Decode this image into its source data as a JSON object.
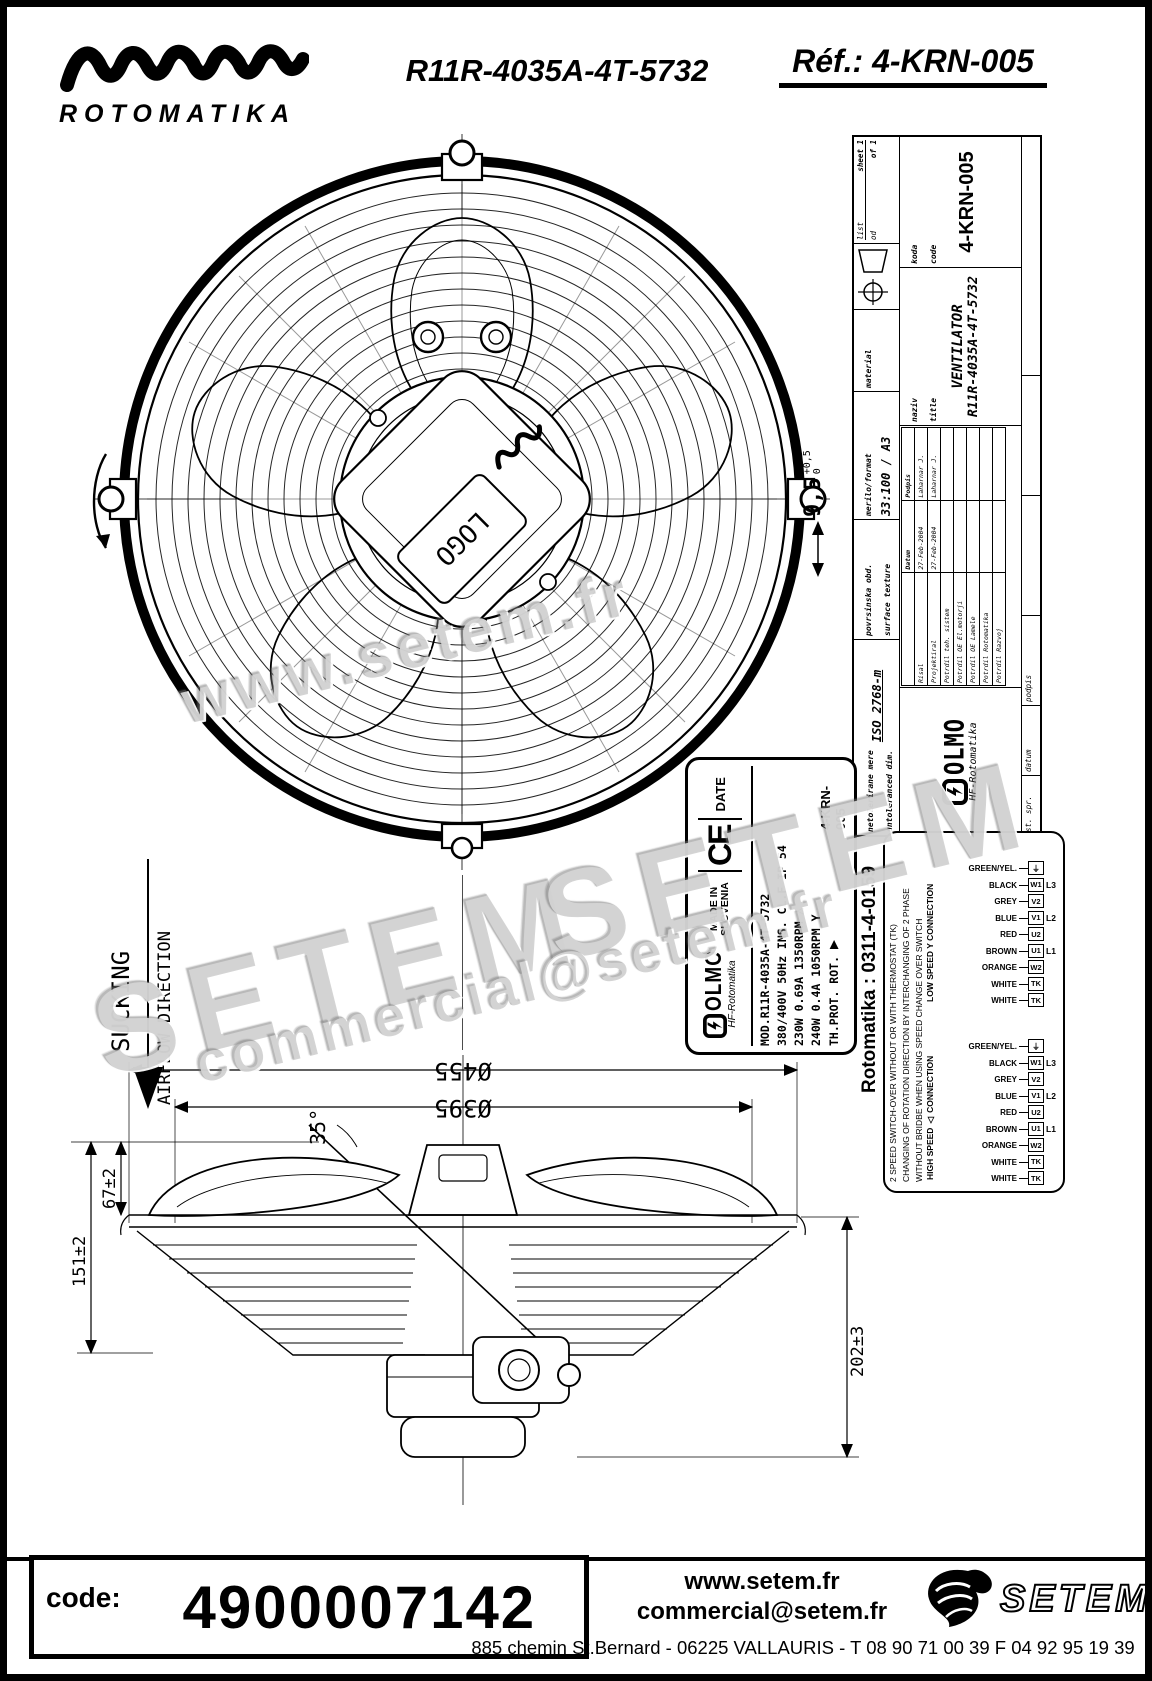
{
  "header": {
    "brand": "ROTOMATIKA",
    "model": "R11R-4035A-4T-5732",
    "ref": "Réf.: 4-KRN-005"
  },
  "front_view": {
    "hub_text": "LOGO",
    "thickness": {
      "value": "9,5",
      "tol_up": "+0,5",
      "tol_dn": "0"
    }
  },
  "airflow": {
    "word": "SUCKING",
    "label": "AIRFLOW DIRECTION"
  },
  "title_block": {
    "untol_sl": "netolerirane mere",
    "untol_en": "untoleranced dim.",
    "iso": "ISO 2768-m",
    "surf_sl": "povrsinska obd.",
    "surf_en": "surface texture",
    "scale_label": "merilo/format",
    "scale": "33:100 / A3",
    "material_label": "material",
    "title_label_sl": "naziv",
    "title_label_en": "title",
    "title1": "VENTILATOR",
    "title2": "R11R-4035A-4T-5732",
    "code_label_sl": "koda",
    "code_label_en": "code",
    "code": "4-KRN-005",
    "sheet_label_sl": "list",
    "sheet_label_en": "sheet 1",
    "of_sl": "od",
    "of_en": "of 1",
    "col_datum": "Datum",
    "col_podpis": "Podpis",
    "rows": [
      {
        "role": "Risal",
        "date": "27-Feb-2004",
        "name": "Laharnar J."
      },
      {
        "role": "Projektiral",
        "date": "27-Feb-2004",
        "name": "Laharnar J."
      },
      {
        "role": "Potrdil teh. sistem",
        "date": "",
        "name": ""
      },
      {
        "role": "Potrdil OE El.motorji",
        "date": "",
        "name": ""
      },
      {
        "role": "Potrdil OE Lamele",
        "date": "",
        "name": ""
      },
      {
        "role": "Potrdil Rotomatika",
        "date": "",
        "name": ""
      },
      {
        "role": "Potrdil Razvoj",
        "date": "",
        "name": ""
      }
    ],
    "footer_cols": [
      "st. spr.",
      "datum",
      "podpis"
    ],
    "brand": "OLMO",
    "brand_sub": "HF-Rotomatika"
  },
  "label": {
    "brand": "OLMO",
    "brand_sub": "HF-Rotomatika",
    "made_in": "MADE IN",
    "country": "SLOVENIA",
    "ce": "CE",
    "date": "DATE",
    "l1": "MOD.R11R-4035A-4T-5732",
    "l2": "380/400V 50Hz INS. CL.F IP 54",
    "l3": "230W 0.69A 1350RPM △",
    "l4": "240W 0.4A 1050RPM Y",
    "l5": "TH.PROT. ROT.",
    "arrow": "▶",
    "code": "4-KRN-005"
  },
  "ref_number": "Rotomatika : 0311-4-0159",
  "wiring": {
    "note1": "2 SPEED SWITCH-OVER WITHOUT OR WITH THERMOSTAT (TK)",
    "note2": "CHANGING OF ROTATION DIRECTION BY INTERCHANGING OF 2 PHASE",
    "note3": "WITHOUT BRIDBE WHEN USING SPEED CHANGE OVER SWITCH",
    "low_label": "LOW SPEED Y CONNECTION",
    "high_label": "HIGH SPEED △ CONNECTION",
    "colors": [
      "GREEN/YEL.",
      "BLACK",
      "GREY",
      "BLUE",
      "RED",
      "BROWN",
      "ORANGE",
      "WHITE",
      "WHITE"
    ],
    "terminals": [
      "⏚",
      "W1",
      "V2",
      "V1",
      "U2",
      "U1",
      "W2",
      "TK",
      "TK"
    ],
    "lines": [
      "",
      "L3",
      "",
      "L2",
      "",
      "L1",
      "",
      "",
      ""
    ]
  },
  "side_view": {
    "d455": "Ø455",
    "d395": "Ø395",
    "angle": "35°",
    "h151": "151±2",
    "h67": "67±2",
    "h202": "202±3"
  },
  "watermarks": {
    "w1": "www.setem.fr",
    "w2": "SETEM",
    "w3": "SETEM",
    "w4": "commercial@setem.fr"
  },
  "footer": {
    "code_label": "code:",
    "code": "4900007142",
    "site": "www.setem.fr",
    "email": "commercial@setem.fr",
    "address": "885 chemin St.Bernard  -  06225 VALLAURIS  -  T 08 90 71 00 39   F 04 92 95 19 39",
    "logo": "SETEM"
  }
}
